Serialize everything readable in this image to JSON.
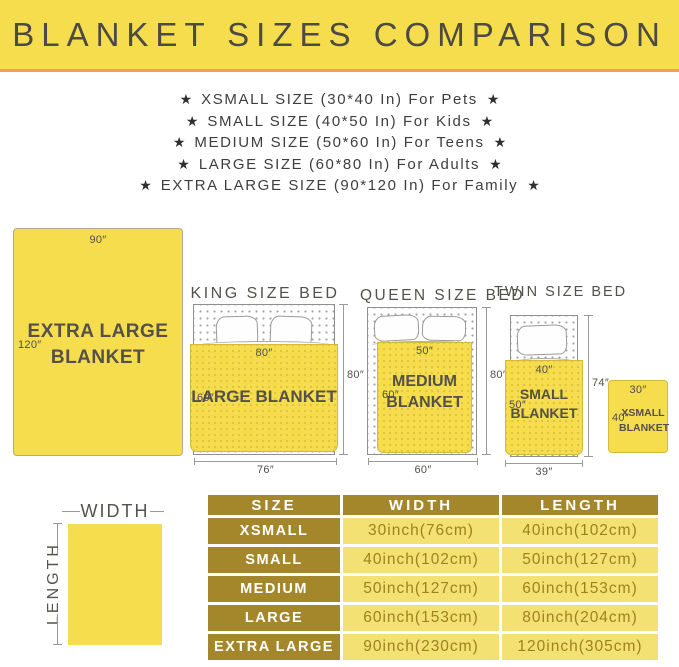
{
  "colors": {
    "banner_yellow": "#f5dd4e",
    "divider_orange": "#eda24f",
    "table_gold": "#a5872b",
    "table_cell_yellow": "#f3e173",
    "table_value_text": "#9f8120",
    "title_text": "#4c4a42"
  },
  "header": {
    "title": "BLANKET SIZES COMPARISON"
  },
  "sizes_list": {
    "star": "★",
    "items": [
      "XSMALL SIZE (30*40 In) For Pets",
      "SMALL SIZE (40*50 In) For Kids",
      "MEDIUM SIZE (50*60 In) For Teens",
      "LARGE SIZE (60*80 In) For Adults",
      "EXTRA LARGE SIZE (90*120 In) For Family"
    ]
  },
  "diagrams": {
    "extra_large": {
      "name_line1": "EXTRA LARGE",
      "name_line2": "BLANKET",
      "width_label": "90″",
      "length_label": "120″"
    },
    "king": {
      "bed_title": "KING SIZE BED",
      "blanket_name": "LARGE BLANKET",
      "blanket_width": "80″",
      "blanket_length": "60″",
      "bed_length": "80″",
      "bed_width": "76″"
    },
    "queen": {
      "bed_title": "QUEEN SIZE BED",
      "name_line1": "MEDIUM",
      "name_line2": "BLANKET",
      "blanket_width": "50″",
      "blanket_length": "60″",
      "bed_length": "80″",
      "bed_width": "60″"
    },
    "twin": {
      "bed_title": "TWIN SIZE BED",
      "name_line1": "SMALL",
      "name_line2": "BLANKET",
      "blanket_width": "40″",
      "blanket_length": "50″",
      "bed_length": "74″",
      "bed_width": "39″"
    },
    "xsmall": {
      "name_line1": "XSMALL",
      "name_line2": "BLANKET",
      "width_label": "30″",
      "length_label": "40″"
    }
  },
  "dimension_key": {
    "width_label": "WIDTH",
    "length_label": "LENGTH"
  },
  "table": {
    "headers": [
      "SIZE",
      "WIDTH",
      "LENGTH"
    ],
    "rows": [
      {
        "size": "XSMALL",
        "width": "30inch(76cm)",
        "length": "40inch(102cm)"
      },
      {
        "size": "SMALL",
        "width": "40inch(102cm)",
        "length": "50inch(127cm)"
      },
      {
        "size": "MEDIUM",
        "width": "50inch(127cm)",
        "length": "60inch(153cm)"
      },
      {
        "size": "LARGE",
        "width": "60inch(153cm)",
        "length": "80inch(204cm)"
      },
      {
        "size": "EXTRA LARGE",
        "width": "90inch(230cm)",
        "length": "120inch(305cm)"
      }
    ]
  }
}
